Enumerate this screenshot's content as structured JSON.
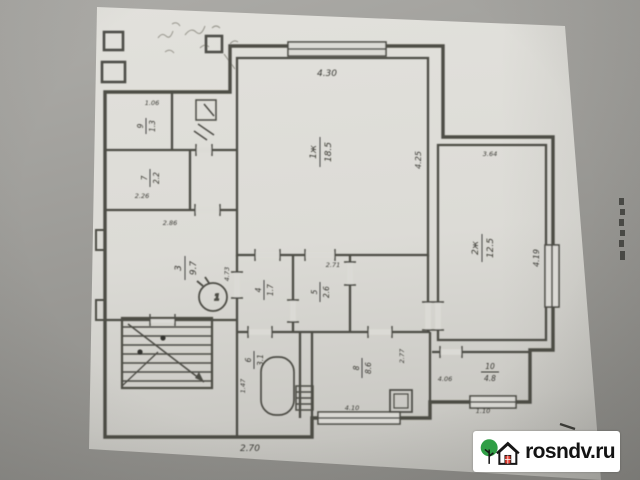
{
  "photo": {
    "background_color": "#9b9a96",
    "paper_color": "#dcdbd6",
    "ink_color": "#45443e"
  },
  "watermark": {
    "site": "rosndv.ru",
    "box_color": "#ffffff",
    "text_color": "#131313",
    "tree_color": "#2f9e45",
    "door_color": "#e03a2e",
    "outline_color": "#161616"
  },
  "plan": {
    "type": "apartment-floor-plan",
    "furnace_label": "1",
    "rooms": [
      {
        "num": "1ж",
        "area": "18.5"
      },
      {
        "num": "2ж",
        "area": "12.5"
      },
      {
        "num": "3",
        "area": "9.7"
      },
      {
        "num": "4",
        "area": "1.7"
      },
      {
        "num": "5",
        "area": "2.6"
      },
      {
        "num": "6",
        "area": "3.1"
      },
      {
        "num": "7",
        "area": "2.2"
      },
      {
        "num": "8",
        "area": "8.6"
      },
      {
        "num": "9",
        "area": "1.3"
      },
      {
        "num": "10",
        "area": "4.8"
      }
    ],
    "dims": {
      "top": "4.30",
      "room1_right": "4.25",
      "room2_top": "3.64",
      "room2_right": "4.19",
      "hall_top": "2.86",
      "hall_right": "4.73",
      "wc_top": "1.06",
      "room7": "2.26",
      "corridor_top": "2.71",
      "kitchen_right": "2.77",
      "kitchen_bottom": "4.10",
      "room10_left": "4.06",
      "room10_bottom": "1.10",
      "bath_left": "1.47",
      "bottom": "2.70"
    }
  }
}
